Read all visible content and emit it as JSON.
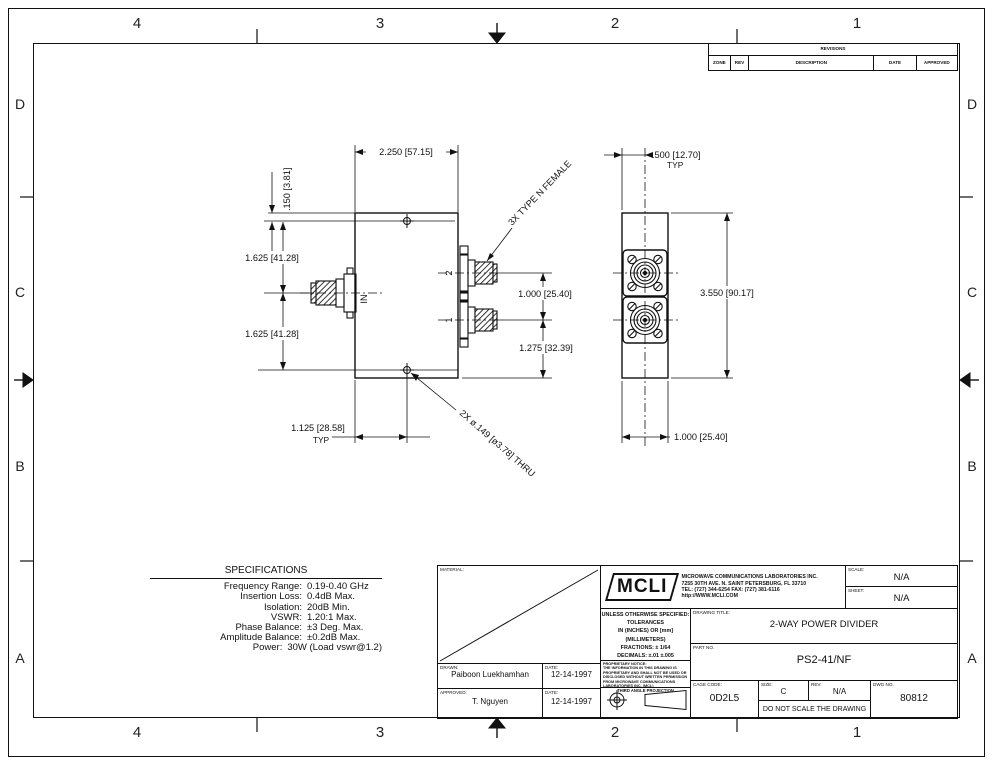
{
  "zones": {
    "columns": [
      "4",
      "3",
      "2",
      "1"
    ],
    "rows": [
      "D",
      "C",
      "B",
      "A"
    ]
  },
  "revisions": {
    "title": "REVISIONS",
    "headers": [
      "ZONE",
      "REV",
      "DESCRIPTION",
      "DATE",
      "APPROVED"
    ]
  },
  "specs": {
    "title": "SPECIFICATIONS",
    "rows": [
      {
        "label": "Frequency Range:",
        "value": "0.19-0.40 GHz"
      },
      {
        "label": "Insertion Loss:",
        "value": "0.4dB Max."
      },
      {
        "label": "Isolation:",
        "value": "20dB Min."
      },
      {
        "label": "VSWR:",
        "value": "1.20:1 Max."
      },
      {
        "label": "Phase Balance:",
        "value": "±3 Deg. Max."
      },
      {
        "label": "Amplitude Balance:",
        "value": "±0.2dB Max."
      },
      {
        "label": "Power:",
        "value": "30W (Load vswr@1.2)"
      }
    ]
  },
  "drawing": {
    "dim_body_width": "2.250 [57.15]",
    "dim_hole_offset": ".150 [3.81]",
    "dim_in_upper": "1.625 [41.28]",
    "dim_in_lower": "1.625 [41.28]",
    "dim_port_spacing": "1.000 [25.40]",
    "dim_port_edge": "1.275 [32.39]",
    "dim_hole_x": "1.125 [28.58]",
    "dim_hole_x_typ": "TYP",
    "note_connectors": "3X TYPE N FEMALE",
    "note_holes": "2X ø.149 [ø3.78] THRU",
    "label_in": "IN",
    "label_port2": "2",
    "label_port1": "1",
    "side_dim_offset": ".500 [12.70]",
    "side_dim_offset_typ": "TYP",
    "side_dim_height": "3.550 [90.17]",
    "side_dim_width": "1.000 [25.40]"
  },
  "title_block": {
    "material_label": "MATERIAL:",
    "drawn_label": "DRAWN:",
    "drawn_name": "Paiboon Luekhamhan",
    "date_label": "DATE:",
    "drawn_date": "12-14-1997",
    "approved_label": "APPROVED:",
    "approved_name": "T. Nguyen",
    "approved_date": "12-14-1997",
    "logo_text": "MCLI",
    "company_line1": "MICROWAVE COMMUNICATIONS LABORATORIES INC.",
    "company_line2": "7255 30TH AVE. N. SAINT PETERSBURG, FL 33710",
    "company_line3": "TEL: (727) 344-6254   FAX: (727) 381-6116",
    "company_line4": "http://WWW.MCLI.COM",
    "scale_label": "SCALE:",
    "scale_value": "N/A",
    "sheet_label": "SHEET:",
    "sheet_value": "N/A",
    "tol_line1": "UNLESS OTHERWISE SPECIFIED:",
    "tol_line2": "TOLERANCES",
    "tol_line3": "IN (INCHES) OR [mm] (MILLIMETERS)",
    "tol_line4": "FRACTIONS: ± 1/64",
    "tol_line5": "DECIMALS: ±.01 ±.005",
    "tol_line6": "ANGLE: ±1/2°",
    "proprietary_title": "PROPRIETARY NOTICE:",
    "proprietary_body": "THE INFORMATION IN THIS DRAWING IS PROPRIETARY AND SHALL NOT BE USED OR DISCLOSED WITHOUT WRITTEN PERMISSION FROM MICROWAVE COMMUNICATIONS LABORATORIES INC. (MCL)",
    "projection_label": "THIRD ANGLE PROJECTION",
    "title_label": "DRAWING TITLE:",
    "title_value": "2-WAY POWER DIVIDER",
    "part_label": "PART NO.",
    "part_value": "PS2-41/NF",
    "cage_label": "CAGE CODE:",
    "cage_value": "0D2L5",
    "size_label": "SIZE:",
    "size_value": "C",
    "rev_label": "REV:",
    "rev_value": "N/A",
    "dwg_label": "DWG NO.",
    "dwg_value": "80812",
    "no_scale": "DO NOT SCALE THE DRAWING"
  }
}
